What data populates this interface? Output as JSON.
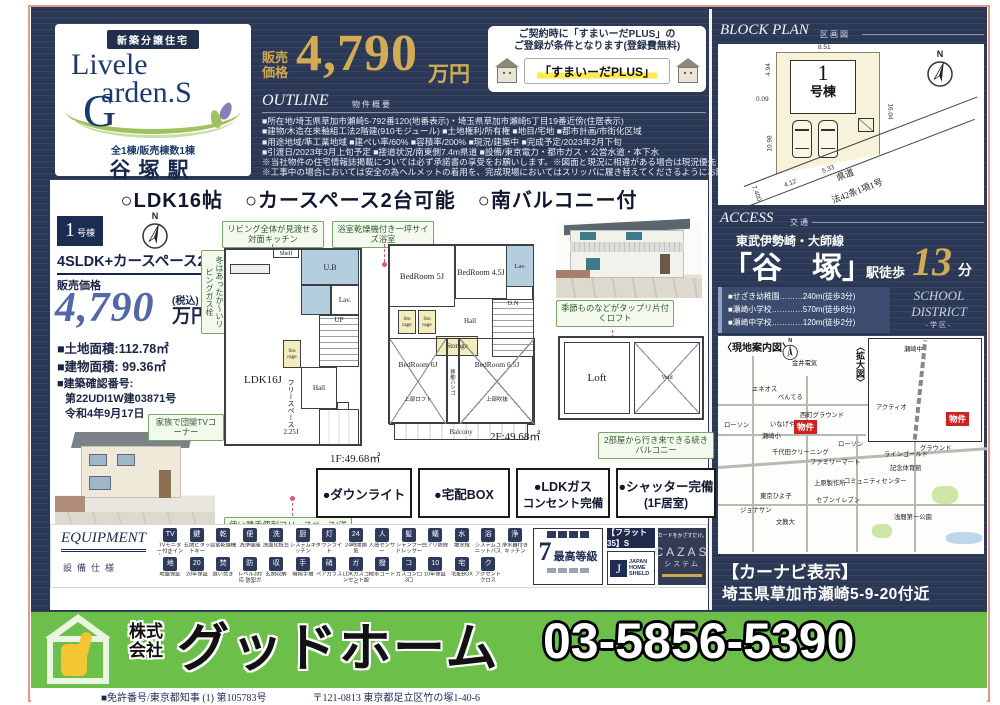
{
  "compass": "N",
  "brand": {
    "badge": "新築分譲住宅",
    "name1": "Livele",
    "name2": "arden.S",
    "g": "G",
    "count": "全1棟/販売棟数1棟",
    "station": "谷塚駅"
  },
  "price": {
    "label1": "販売",
    "label2": "価格",
    "value": "4,790",
    "unit": "万円"
  },
  "sumaida": {
    "line1": "ご契約時に「すまいーだPLUS」の",
    "line2": "ご登録が条件となります(登録費無料)",
    "banner": "「すまいーだPLUS」"
  },
  "outline": {
    "title": "OUTLINE",
    "subtitle": "物件概要",
    "lines": [
      "■所在地/埼玉県草加市瀬崎5-792番120(地番表示)・埼玉県草加市瀬崎5丁目19番近傍(住居表示)",
      "■建物/木造在来軸組工法2階建(910モジュール) ■土地権利/所有権 ■地目/宅地 ■都市計画/市街化区域",
      "■用途地域/準工業地域 ■建ぺい率/60% ■容積率/200% ■現況/建築中 ■完成予定/2023年2月下旬",
      "■引渡日/2023年3月上旬予定 ■接道状況/南東側7.4m県道 ■設備/東京電力・都市ガス・公営水道・本下水",
      "※当社物件の住宅情報誌掲載については必ず承諾書の享受をお願いします。※図面と現況に相違がある場合は現況優先とします。",
      "※工事中の場合においては安全の為ヘルメットの着用を、完成現場においてはスリッパに履き替えてくださるようにお願い致します。"
    ]
  },
  "features": [
    "○LDK16帖",
    "○カースペース2台可能",
    "○南バルコニー付"
  ],
  "unit": {
    "badge_num": "1",
    "badge_suffix": "号棟",
    "plan": "4SLDK+カースペース2台",
    "price_label": "販売価格",
    "price_value": "4,790",
    "price_tax": "(税込)",
    "price_unit": "万円",
    "land": "■土地面積:112.78㎡",
    "building": "■建物面積: 99.36㎡",
    "approval_label": "■建築確認番号:",
    "approval_no": "第22UDI1W建03871号",
    "approval_date": "令和4年9月17日"
  },
  "floorplan": {
    "f1_caption": "1F:49.68㎡",
    "f2_caption": "2F:49.68㎡",
    "rooms": {
      "ldk": "LDK16J",
      "shelf": "Shelf",
      "ub": "U.B",
      "lav": "Lav.",
      "up": "UP",
      "dn": "D.N",
      "hall": "Hall",
      "sto": "Sto rage",
      "free1": "フリースペース",
      "free2": "2.25J",
      "shoes": "Shoes",
      "bed5": "BedRoom 5J",
      "bed45": "BedRoom 4.5J",
      "bed6": "BedRoom 6J",
      "bed65": "BedRoom 6.5J",
      "storage": "Storage",
      "loftnote": "上部ロフト",
      "fukinuke": "上部吹抜",
      "hashigo": "移動ハシゴ",
      "balcony": "Balcony",
      "loft": "Loft",
      "void": "Void"
    },
    "callouts": {
      "kitchen": "リビング全体が見渡せる対面キッチン",
      "bath": "浴室乾燥機付き一坪サイズ浴室",
      "gas": "冬はあったか〜いリビングガス栓",
      "tv": "家族で団欒TVコーナー",
      "free": "使い勝手便利フリースペース(洋室タイプ)戸を外せば18.25帖にもなります",
      "loft": "季節ものなどがタップリ片付くロフト",
      "balcony": "2部屋から行き来できる続きバルコニー"
    }
  },
  "feature_boxes": [
    {
      "l1": "●ダウンライト",
      "l2": ""
    },
    {
      "l1": "●宅配BOX",
      "l2": ""
    },
    {
      "l1": "●LDKガス",
      "l2": "コンセント完備"
    },
    {
      "l1": "●シャッター完備",
      "l2": "(1F居室)"
    }
  ],
  "block_plan": {
    "title": "BLOCK PLAN",
    "subtitle": "区画図",
    "num": "1",
    "suffix": "号棟",
    "dims": {
      "top": "8.51",
      "left_upper": "4.94",
      "left_small": "0.09",
      "right": "16.04",
      "left_lower": "10.98",
      "bottom1": "4.12",
      "bottom2": "5.33",
      "diag": "7.400"
    },
    "road1": "県道",
    "road2": "法42条1項1号"
  },
  "access": {
    "title": "ACCESS",
    "subtitle": "交通",
    "line": "東武伊勢崎・大師線",
    "station": "「谷　塚」",
    "suffix": "駅徒歩",
    "minutes": "13",
    "min_unit": "分",
    "schools": [
      "■せざき幼稚園………240m(徒歩3分)",
      "■瀬崎小学校…………570m(徒歩8分)",
      "■瀬崎中学校…………120m(徒歩2分)"
    ],
    "district1": "SCHOOL",
    "district2": "DISTRICT",
    "district3": "-学区-"
  },
  "map": {
    "title": "〈現地案内図〉",
    "inset_title": "〈拡大図〉",
    "bukken": "物件",
    "labels": [
      {
        "t": "金井電気",
        "x": 74,
        "y": 22
      },
      {
        "t": "エネオス",
        "x": 34,
        "y": 48
      },
      {
        "t": "べんてる",
        "x": 60,
        "y": 56
      },
      {
        "t": "西町グラウンド",
        "x": 82,
        "y": 74
      },
      {
        "t": "ローソン",
        "x": 6,
        "y": 84
      },
      {
        "t": "いなげや",
        "x": 52,
        "y": 83
      },
      {
        "t": "瀬崎小",
        "x": 44,
        "y": 95
      },
      {
        "t": "千代田クリーニング",
        "x": 54,
        "y": 111
      },
      {
        "t": "ローソン",
        "x": 120,
        "y": 103
      },
      {
        "t": "ファミリーマート",
        "x": 92,
        "y": 121
      },
      {
        "t": "ラインゴールド",
        "x": 166,
        "y": 113
      },
      {
        "t": "グラウンド",
        "x": 202,
        "y": 107
      },
      {
        "t": "記念体育館",
        "x": 172,
        "y": 127
      },
      {
        "t": "コミュニティセンター",
        "x": 126,
        "y": 140
      },
      {
        "t": "上原製作所",
        "x": 96,
        "y": 142
      },
      {
        "t": "東京ひよ子",
        "x": 42,
        "y": 155
      },
      {
        "t": "セブンイレブン",
        "x": 98,
        "y": 159
      },
      {
        "t": "ジョナサン",
        "x": 22,
        "y": 169
      },
      {
        "t": "文教大",
        "x": 58,
        "y": 181
      },
      {
        "t": "浅間第一公園",
        "x": 176,
        "y": 176
      },
      {
        "t": "瀬崎中",
        "x": 186,
        "y": 8
      },
      {
        "t": "アクティオ",
        "x": 158,
        "y": 66
      }
    ]
  },
  "carnavi": {
    "title": "【カーナビ表示】",
    "address": "埼玉県草加市瀬崎5-9-20付近"
  },
  "equipment": {
    "title": "EQUIPMENT",
    "subtitle": "設備仕様",
    "rows": [
      [
        {
          "g": "TV",
          "t": "TVモニター付きインターフォン"
        },
        {
          "g": "鍵",
          "t": "玄関ピタットキー"
        },
        {
          "g": "乾",
          "t": "浴室乾燥機"
        },
        {
          "g": "便",
          "t": "洗浄便座"
        },
        {
          "g": "洗",
          "t": "洗面化粧台"
        },
        {
          "g": "厨",
          "t": "システムキッチン"
        },
        {
          "g": "灯",
          "t": "ダウンライト"
        },
        {
          "g": "24",
          "t": "24時間換気"
        },
        {
          "g": "人",
          "t": "人感センサー"
        },
        {
          "g": "髪",
          "t": "シャンプードレッサー"
        },
        {
          "g": "蟻",
          "t": "白アリ防除"
        },
        {
          "g": "水",
          "t": "散水栓"
        },
        {
          "g": "浴",
          "t": "システムユニットバス"
        },
        {
          "g": "浄",
          "t": "浄水器付きキッチン"
        }
      ],
      [
        {
          "g": "地",
          "t": "地盤保証"
        },
        {
          "g": "20",
          "t": "20年保証"
        },
        {
          "g": "焚",
          "t": "追い焚き"
        },
        {
          "g": "防",
          "t": "レベル3対応 防犯ガラス"
        },
        {
          "g": "収",
          "t": "玄関収納"
        },
        {
          "g": "手",
          "t": "階段手摺"
        },
        {
          "g": "硝",
          "t": "ペアガラス"
        },
        {
          "g": "ガ",
          "t": "LDKガスコンセント設置"
        },
        {
          "g": "撥",
          "t": "撥水コート"
        },
        {
          "g": "コ",
          "t": "ガスコンロ3口"
        },
        {
          "g": "10",
          "t": "10年保証"
        },
        {
          "g": "宅",
          "t": "宅配BOX"
        },
        {
          "g": "ク",
          "t": "アクセントクロス"
        }
      ]
    ],
    "badges": {
      "grade_num": "7",
      "grade_text": "最高等級",
      "flat35": "【フラット35】S",
      "jhs_j": "J",
      "jhs1": "JAPAN",
      "jhs2": "HOME",
      "jhs3": "SHIELD",
      "cazas_top": "カードをかざすだけ。",
      "cazas": "CAZAS",
      "cazas_sub": "システム"
    }
  },
  "footer": {
    "prefix1": "株式",
    "prefix2": "会社",
    "name": "グッドホーム",
    "phone": "03-5856-5390",
    "license": "■免許番号/東京都知事 (1) 第105783号",
    "address": "〒121-0813 東京都足立区竹の塚1-40-6"
  }
}
